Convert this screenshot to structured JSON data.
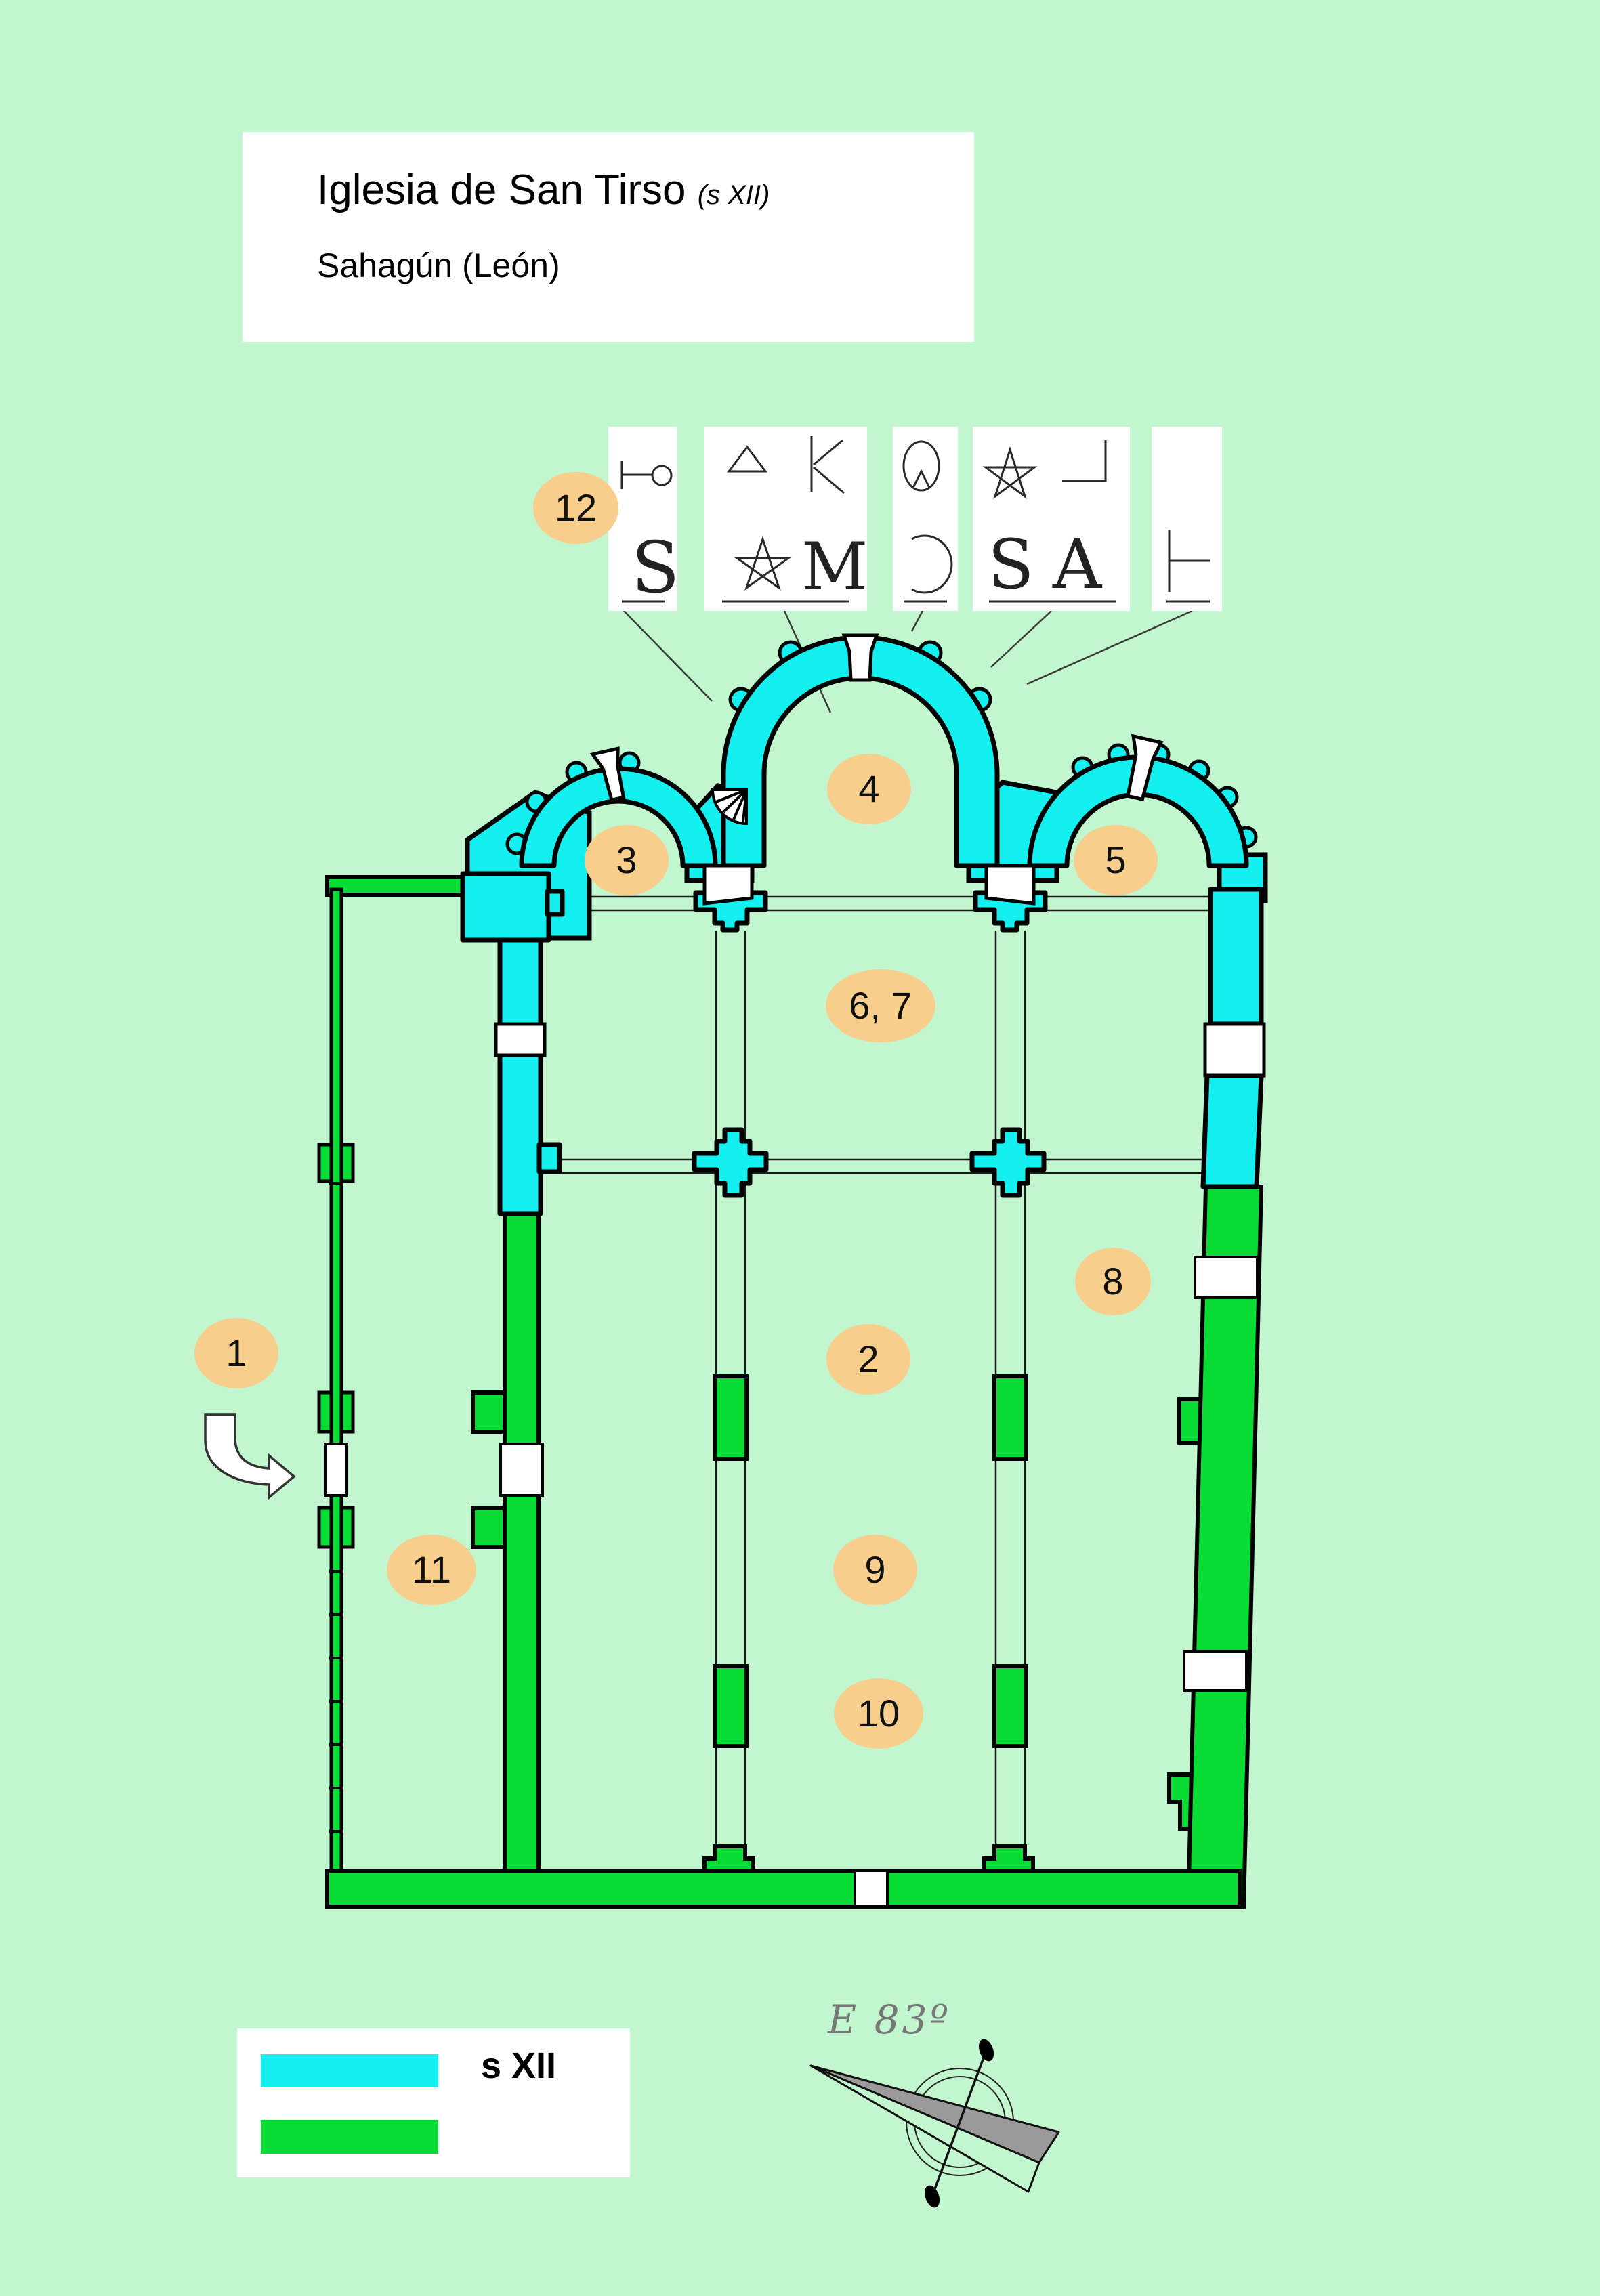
{
  "page": {
    "background_color": "#C2F6CF"
  },
  "colors": {
    "s_xii_cyan": "#14EFEF",
    "later_phase_green": "#0ADC36",
    "label_oval_orange": "#F7CE8B",
    "wall_outline": "#000000"
  },
  "title": {
    "main": "Iglesia de San Tirso",
    "period": "(s XII)",
    "location": "Sahagún (León)"
  },
  "plan_labels": [
    {
      "id": "1",
      "text": "1"
    },
    {
      "id": "2",
      "text": "2"
    },
    {
      "id": "3",
      "text": "3"
    },
    {
      "id": "4",
      "text": "4"
    },
    {
      "id": "5",
      "text": "5"
    },
    {
      "id": "6-7",
      "text": "6, 7"
    },
    {
      "id": "8",
      "text": "8"
    },
    {
      "id": "9",
      "text": "9"
    },
    {
      "id": "10",
      "text": "10"
    },
    {
      "id": "11",
      "text": "11"
    },
    {
      "id": "12",
      "text": "12"
    }
  ],
  "mason_marks": {
    "box1": {
      "top_mark": "hooked-bar-mark",
      "bottom_letter": "S"
    },
    "box2": {
      "top_marks": [
        "triangle-mark",
        "K-mark"
      ],
      "top_letter": "K",
      "bottom_marks": [
        "pentagram-mark",
        "M-mark"
      ],
      "bottom_letter": "M"
    },
    "box3": {
      "top_mark": "tulip-Q-mark",
      "bottom_mark": "reversed-C-mark"
    },
    "box4": {
      "top_marks": [
        "pentagram-mark",
        "rotated-L-mark"
      ],
      "bottom_letter_s": "S",
      "bottom_letter_a": "A"
    },
    "box5": {
      "bottom_mark": "rotated-T-mark"
    }
  },
  "legend": {
    "items": [
      {
        "label": "s XII",
        "color": "#14EFEF"
      },
      {
        "label": "",
        "color": "#0ADC36"
      }
    ]
  },
  "compass": {
    "bearing_label": "E 83º"
  }
}
